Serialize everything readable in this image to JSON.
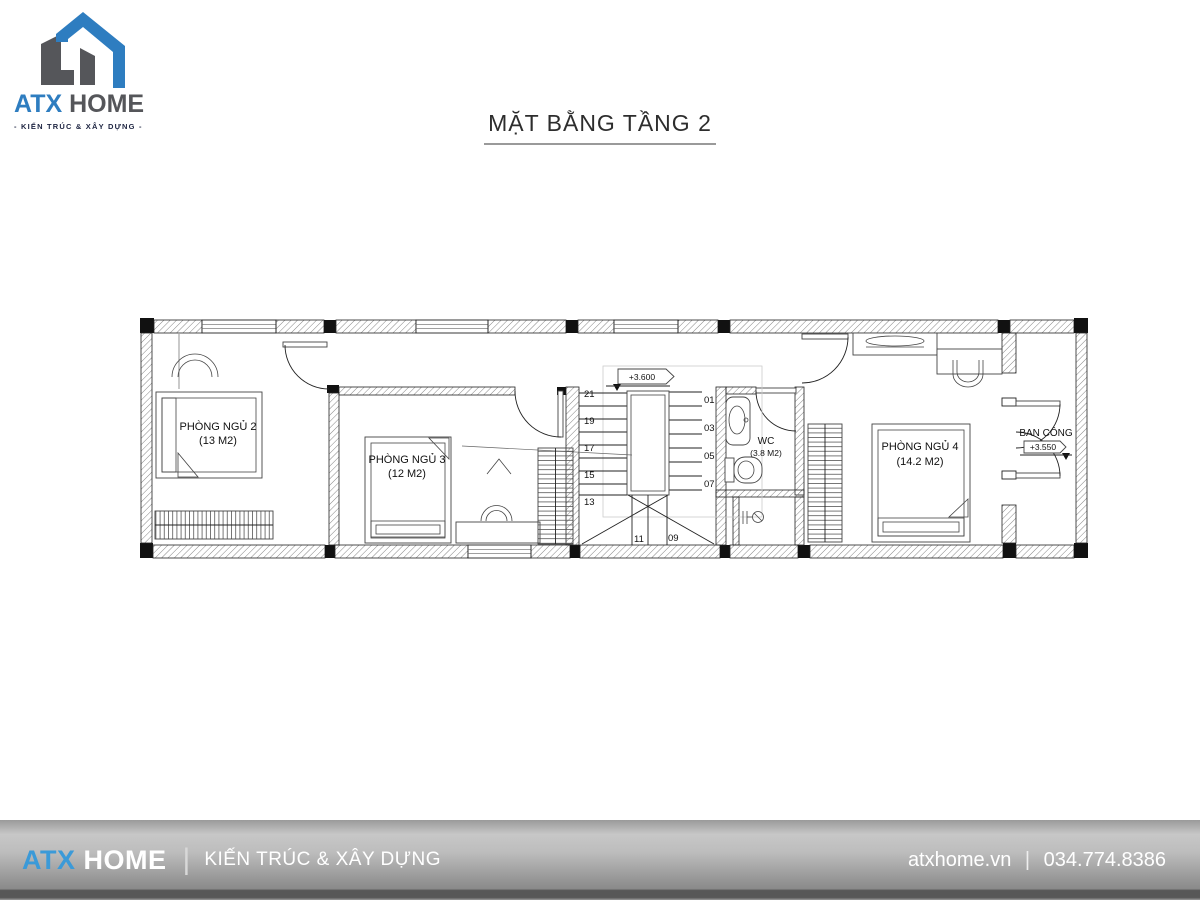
{
  "logo": {
    "brand_primary": "ATX",
    "brand_secondary": "HOME",
    "tagline": "- KIẾN TRÚC & XÂY DỰNG -"
  },
  "title": {
    "text": "MẶT BẰNG TẦNG 2"
  },
  "plan": {
    "rooms": [
      {
        "name": "PHÒNG NGỦ 2",
        "area": "(13 M2)"
      },
      {
        "name": "PHÒNG NGỦ 3",
        "area": "(12 M2)"
      },
      {
        "name": "PHÒNG NGỦ 4",
        "area": "(14.2 M2)"
      },
      {
        "name": "WC",
        "area": "(3.8 M2)"
      },
      {
        "name": "BAN CÔNG",
        "level": "+3.550"
      }
    ],
    "stairs": {
      "level_label": "+3.600",
      "left_numbers": [
        "21",
        "19",
        "17",
        "15",
        "13"
      ],
      "right_numbers": [
        "01",
        "03",
        "05",
        "07"
      ],
      "bottom_numbers": [
        "11",
        "09"
      ]
    }
  },
  "footer": {
    "brand_primary": "ATX",
    "brand_secondary": "HOME",
    "divider": "|",
    "tagline": "KIẾN TRÚC & XÂY DỰNG",
    "website": "atxhome.vn",
    "separator": "|",
    "phone": "034.774.8386"
  },
  "colors": {
    "logo_blue": "#2e7dc0",
    "logo_gray": "#55565a",
    "footer_blue": "#3b9ad8",
    "tagline_navy": "#1c2340",
    "footer_gray_top": "#c7c7c7",
    "footer_gray_bottom": "#575757"
  }
}
